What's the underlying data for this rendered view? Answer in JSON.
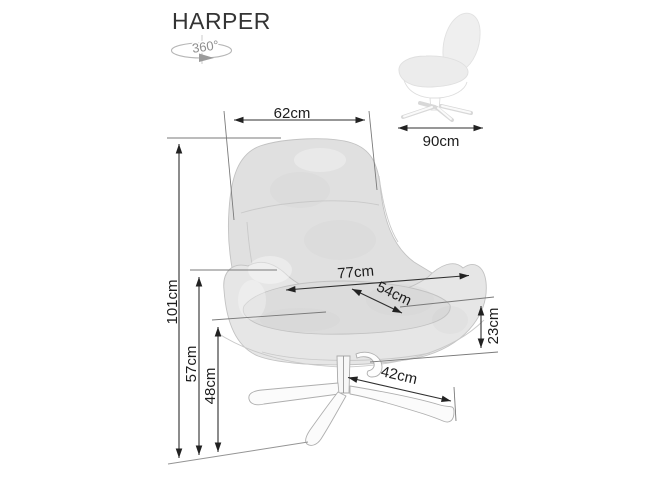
{
  "product": {
    "title": "HARPER"
  },
  "rotation_badge": {
    "label": "360°",
    "icon": "rotation-360-icon"
  },
  "side_view": {
    "depth": {
      "label": "90cm"
    }
  },
  "front_view": {
    "backrest_width": {
      "label": "62cm"
    },
    "total_height": {
      "label": "101cm"
    },
    "armrest_height": {
      "label": "57cm"
    },
    "seat_height": {
      "label": "48cm"
    },
    "overall_width": {
      "label": "77cm"
    },
    "seat_depth": {
      "label": "54cm"
    },
    "shell_height": {
      "label": "23cm"
    },
    "base_width": {
      "label": "42cm"
    }
  },
  "colors": {
    "background": "#ffffff",
    "dimension_line": "#2f2f2f",
    "extension_line": "#7a7a7a",
    "label_text": "#1d1d1d",
    "title_text": "#343434",
    "rotation_icon": "#a8a8a8",
    "fabric": "#e0e0e0",
    "fabric_shadow": "#cfcfcf",
    "outline": "#c2c2c2"
  }
}
